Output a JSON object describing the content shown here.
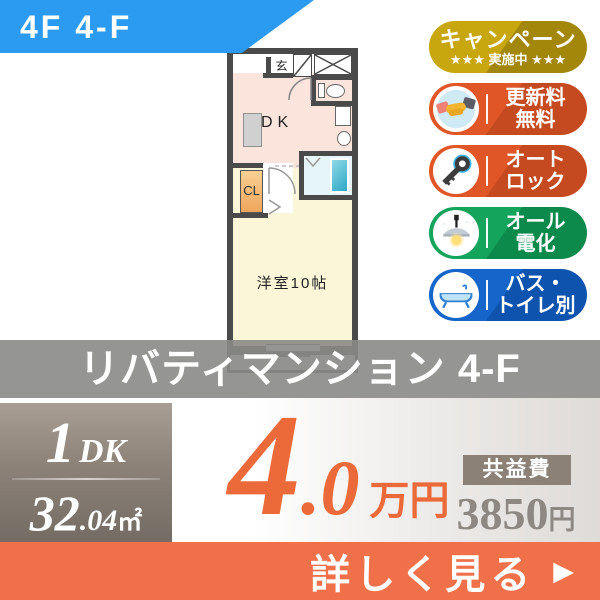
{
  "corner_badge": {
    "label": "4F 4-F"
  },
  "floorplan": {
    "genkan": "玄",
    "dk": "DK",
    "cl": "CL",
    "room": "洋室10帖"
  },
  "feature_badges": [
    {
      "id": "campaign",
      "line1": "キャンペーン",
      "line2": "★★★ 実施中 ★★★",
      "icon": "none"
    },
    {
      "id": "no-renewal-fee",
      "line1": "更新料",
      "line2": "無料",
      "icon": "handshake-icon"
    },
    {
      "id": "auto-lock",
      "line1": "オート",
      "line2": "ロック",
      "icon": "key-icon"
    },
    {
      "id": "all-electric",
      "line1": "オール",
      "line2": "電化",
      "icon": "pendant-lamp-icon"
    },
    {
      "id": "separate-bath-toilet",
      "line1": "バス・",
      "line2": "トイレ別",
      "icon": "bathtub-icon"
    }
  ],
  "property": {
    "name": "リバティマンション 4-F"
  },
  "stats": {
    "type_main": "1",
    "type_sub": "DK",
    "area_main": "32",
    "area_frac": ".04",
    "area_unit": "㎡",
    "rent_main": "4",
    "rent_frac": ".0",
    "rent_unit": "万円",
    "fee_label": "共益費",
    "fee_value": "3850",
    "fee_unit": "円"
  },
  "cta": {
    "label": "詳しく見る",
    "arrow": "▶"
  },
  "colors": {
    "corner_blue": "#2b9bf1",
    "badge_gold": "#b8960c",
    "badge_orange": "#d85226",
    "badge_green": "#12a159",
    "badge_blue": "#1465c9",
    "accent_orange": "#ec6a39",
    "bar_orange": "#ef7049",
    "taupe": "#8c8278",
    "band_gray": "#8a8987",
    "wall_gray": "#4a4a4a"
  }
}
